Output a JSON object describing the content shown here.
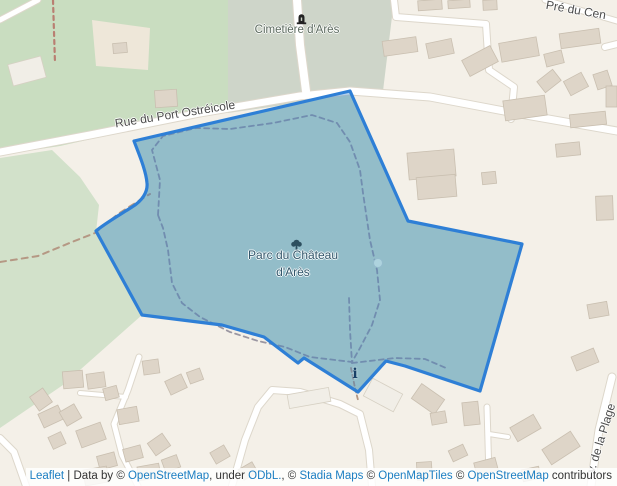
{
  "window": {
    "width": 617,
    "height": 486,
    "app": "Leaflet map"
  },
  "colors": {
    "background": "#f4f0e8",
    "wood_north": "#c9ddc0",
    "wood_west": "#d2e1ca",
    "cemetery": "#ced5c9",
    "clearing": "#eee7d9",
    "park_base": "#cfe0ca",
    "road_fill": "#ffffff",
    "road_casing": "#ddd7cb",
    "building": "#ded5c8",
    "building_stroke": "#c9bfb0",
    "building_light": "#f1eee7",
    "building_light_stroke": "#d6d0c3",
    "overlay_fill": "rgba(34,124,201,0.35)",
    "overlay_stroke": "#2e7fd6",
    "path_gray": "#9b97a2",
    "path_brown": "#b59884",
    "fence_brown": "#b97f72",
    "pond_fill": "#aed3de",
    "pond_stroke": "#95bccd",
    "label_park": "#33576b",
    "label_cemetery": "#5c6b5f",
    "label_road": "#4c4c4c",
    "link_blue": "#1b7ec2",
    "attribution_text": "#333333",
    "grave_icon": "#222222",
    "tree_icon": "#2d4f5f",
    "info_icon": "#173f66"
  },
  "labels": {
    "cemetery": "Cimetière d'Arès",
    "park_line1": "Parc du Château",
    "park_line2": "d'Arès",
    "road_main": "Rue du Port Ostréicole",
    "road_top_right": "Pré du Cen",
    "road_right": "v. de la Plage",
    "info_marker": "i"
  },
  "attribution": {
    "segments": [
      {
        "text": "Leaflet",
        "link": true
      },
      {
        "text": " | Data by © ",
        "link": false
      },
      {
        "text": "OpenStreetMap",
        "link": true
      },
      {
        "text": ", under ",
        "link": false
      },
      {
        "text": "ODbL.",
        "link": true
      },
      {
        "text": ", © ",
        "link": false
      },
      {
        "text": "Stadia Maps",
        "link": true
      },
      {
        "text": " © ",
        "link": false
      },
      {
        "text": "OpenMapTiles",
        "link": true
      },
      {
        "text": " © ",
        "link": false
      },
      {
        "text": "OpenStreetMap",
        "link": true
      },
      {
        "text": " contributors",
        "link": false
      }
    ]
  },
  "map": {
    "regions": [
      {
        "name": "wood-north",
        "fill": "#c9ddc0",
        "pts": [
          [
            0,
            0
          ],
          [
            228,
            0
          ],
          [
            228,
            112
          ],
          [
            150,
            126
          ],
          [
            60,
            146
          ],
          [
            0,
            155
          ]
        ]
      },
      {
        "name": "wood-west",
        "fill": "#d2e1ca",
        "pts": [
          [
            0,
            158
          ],
          [
            52,
            150
          ],
          [
            80,
            177
          ],
          [
            99,
            205
          ],
          [
            96,
            232
          ],
          [
            142,
            315
          ],
          [
            63,
            385
          ],
          [
            0,
            428
          ]
        ]
      },
      {
        "name": "cemetery-grounds",
        "fill": "#ced5c9",
        "pts": [
          [
            228,
            0
          ],
          [
            394,
            0
          ],
          [
            383,
            91
          ],
          [
            228,
            113
          ]
        ]
      },
      {
        "name": "clearing",
        "fill": "#eee7d9",
        "pts": [
          [
            92,
            20
          ],
          [
            150,
            28
          ],
          [
            148,
            70
          ],
          [
            96,
            66
          ]
        ]
      }
    ],
    "park": {
      "path": "M350,91 L408,221 L522,244 L480,391 L405,366 L386,361 L358,392 L304,358 L298,363 L264,337 L222,325 L142,315 L96,231 C104,224 118,216 132,207 C142,201 148,192 147,183 C146,170 138,152 134,141 Z"
    },
    "roads": [
      {
        "w": 7,
        "pts": [
          [
            0,
            152
          ],
          [
            90,
            135
          ],
          [
            200,
            113
          ],
          [
            300,
            96
          ],
          [
            350,
            91
          ],
          [
            430,
            97
          ],
          [
            520,
            114
          ],
          [
            617,
            131
          ]
        ]
      },
      {
        "w": 8,
        "pts": [
          [
            297,
            0
          ],
          [
            300,
            45
          ],
          [
            306,
            91
          ]
        ]
      },
      {
        "w": 6,
        "pts": [
          [
            394,
            0
          ],
          [
            396,
            17
          ],
          [
            486,
            24
          ],
          [
            489,
            70
          ],
          [
            514,
            87
          ],
          [
            511,
            119
          ]
        ]
      },
      {
        "w": 6,
        "pts": [
          [
            605,
            47
          ],
          [
            617,
            44
          ]
        ]
      },
      {
        "w": 5,
        "pts": [
          [
            545,
            0
          ],
          [
            617,
            21
          ]
        ]
      },
      {
        "w": 6,
        "pts": [
          [
            0,
            438
          ],
          [
            14,
            452
          ],
          [
            26,
            486
          ]
        ]
      },
      {
        "w": 5,
        "pts": [
          [
            139,
            357
          ],
          [
            128,
            390
          ],
          [
            114,
            424
          ],
          [
            122,
            455
          ],
          [
            138,
            486
          ]
        ]
      },
      {
        "w": 4,
        "pts": [
          [
            80,
            393
          ],
          [
            126,
            397
          ]
        ]
      },
      {
        "w": 6,
        "pts": [
          [
            232,
            486
          ],
          [
            245,
            440
          ],
          [
            258,
            407
          ],
          [
            272,
            390
          ],
          [
            300,
            392
          ],
          [
            340,
            404
          ],
          [
            360,
            414
          ],
          [
            369,
            450
          ],
          [
            372,
            486
          ]
        ]
      },
      {
        "w": 5,
        "pts": [
          [
            487,
            407
          ],
          [
            489,
            477
          ]
        ]
      },
      {
        "w": 4,
        "pts": [
          [
            489,
            434
          ],
          [
            508,
            437
          ]
        ]
      },
      {
        "w": 7,
        "pts": [
          [
            612,
            377
          ],
          [
            599,
            430
          ],
          [
            591,
            486
          ]
        ]
      },
      {
        "w": 5,
        "pts": [
          [
            0,
            20
          ],
          [
            38,
            0
          ]
        ]
      }
    ],
    "paths": [
      {
        "color": "#b59884",
        "w": 2,
        "dash": "6,5",
        "pts": [
          [
            0,
            262
          ],
          [
            38,
            256
          ],
          [
            72,
            242
          ],
          [
            95,
            233
          ],
          [
            118,
            214
          ],
          [
            140,
            200
          ],
          [
            150,
            194
          ]
        ]
      },
      {
        "color": "#b97f72",
        "w": 2.2,
        "dash": "4,4",
        "pts": [
          [
            53,
            0
          ],
          [
            54,
            32
          ],
          [
            55,
            63
          ]
        ]
      },
      {
        "color": "#b59884",
        "w": 1.8,
        "dash": "4,3",
        "pts": [
          [
            351,
            368
          ],
          [
            355,
            388
          ],
          [
            358,
            400
          ]
        ]
      },
      {
        "color": "#9b97a2",
        "w": 1.8,
        "dash": "5,4",
        "pts": [
          [
            158,
            215
          ],
          [
            160,
            180
          ],
          [
            152,
            150
          ],
          [
            163,
            136
          ],
          [
            196,
            128
          ],
          [
            230,
            129
          ],
          [
            273,
            123
          ],
          [
            312,
            115
          ],
          [
            337,
            123
          ],
          [
            350,
            142
          ],
          [
            360,
            170
          ],
          [
            363,
            193
          ],
          [
            370,
            240
          ],
          [
            377,
            270
          ],
          [
            380,
            300
          ],
          [
            372,
            325
          ],
          [
            360,
            348
          ],
          [
            352,
            362
          ],
          [
            310,
            357
          ],
          [
            285,
            347
          ],
          [
            258,
            341
          ],
          [
            230,
            332
          ],
          [
            200,
            317
          ],
          [
            182,
            303
          ],
          [
            172,
            283
          ],
          [
            168,
            250
          ],
          [
            163,
            228
          ],
          [
            158,
            215
          ]
        ]
      },
      {
        "color": "#9b97a2",
        "w": 1.8,
        "dash": "5,4",
        "pts": [
          [
            349,
            298
          ],
          [
            350,
            330
          ],
          [
            352,
            363
          ]
        ]
      },
      {
        "color": "#9b97a2",
        "w": 1.8,
        "dash": "5,4",
        "pts": [
          [
            352,
            363
          ],
          [
            395,
            358
          ],
          [
            425,
            359
          ],
          [
            446,
            368
          ]
        ]
      }
    ],
    "buildings": [
      [
        10,
        60,
        34,
        22,
        -15,
        "light"
      ],
      [
        113,
        43,
        14,
        10,
        -5
      ],
      [
        155,
        90,
        22,
        17,
        -4
      ],
      [
        383,
        39,
        34,
        15,
        -8
      ],
      [
        427,
        41,
        26,
        15,
        -12
      ],
      [
        464,
        52,
        32,
        18,
        -28
      ],
      [
        500,
        40,
        38,
        19,
        -10
      ],
      [
        545,
        52,
        18,
        13,
        -14
      ],
      [
        560,
        31,
        40,
        15,
        -8
      ],
      [
        539,
        74,
        20,
        14,
        -38
      ],
      [
        566,
        76,
        20,
        16,
        -28
      ],
      [
        595,
        72,
        15,
        16,
        -18
      ],
      [
        418,
        0,
        24,
        10,
        -4
      ],
      [
        448,
        0,
        22,
        8,
        -4
      ],
      [
        483,
        0,
        14,
        10,
        -3
      ],
      [
        504,
        98,
        42,
        20,
        -8
      ],
      [
        606,
        86,
        11,
        21,
        0
      ],
      [
        570,
        113,
        36,
        13,
        -6
      ],
      [
        556,
        143,
        24,
        13,
        -6
      ],
      [
        596,
        196,
        17,
        24,
        -2
      ],
      [
        482,
        172,
        14,
        12,
        -6
      ],
      [
        408,
        151,
        47,
        27,
        -5
      ],
      [
        417,
        176,
        39,
        22,
        -5
      ],
      [
        588,
        303,
        20,
        14,
        -10
      ],
      [
        573,
        352,
        24,
        15,
        -22
      ],
      [
        63,
        371,
        20,
        17,
        -5
      ],
      [
        87,
        373,
        18,
        15,
        -8
      ],
      [
        33,
        391,
        16,
        17,
        -35
      ],
      [
        40,
        409,
        22,
        15,
        -25
      ],
      [
        62,
        407,
        17,
        16,
        -30
      ],
      [
        78,
        426,
        26,
        18,
        -20
      ],
      [
        50,
        434,
        14,
        13,
        -25
      ],
      [
        104,
        387,
        14,
        12,
        -15
      ],
      [
        118,
        408,
        20,
        15,
        -10
      ],
      [
        98,
        454,
        18,
        14,
        -15
      ],
      [
        84,
        468,
        24,
        16,
        -10
      ],
      [
        124,
        447,
        18,
        13,
        -15
      ],
      [
        150,
        437,
        18,
        15,
        -35
      ],
      [
        138,
        465,
        22,
        14,
        -10
      ],
      [
        163,
        457,
        16,
        13,
        -20
      ],
      [
        143,
        360,
        16,
        14,
        -8
      ],
      [
        167,
        377,
        18,
        15,
        -25
      ],
      [
        188,
        370,
        14,
        12,
        -20
      ],
      [
        212,
        448,
        16,
        13,
        -30
      ],
      [
        240,
        465,
        16,
        12,
        -30
      ],
      [
        288,
        391,
        42,
        14,
        -10,
        "light"
      ],
      [
        366,
        385,
        34,
        20,
        28,
        "light"
      ],
      [
        414,
        390,
        28,
        18,
        35
      ],
      [
        463,
        402,
        16,
        23,
        -6
      ],
      [
        431,
        412,
        15,
        12,
        -10
      ],
      [
        512,
        420,
        27,
        16,
        -30
      ],
      [
        544,
        439,
        34,
        18,
        -33
      ],
      [
        450,
        447,
        16,
        12,
        -25
      ],
      [
        475,
        460,
        22,
        13,
        -15
      ],
      [
        522,
        468,
        18,
        12,
        -12
      ],
      [
        417,
        462,
        15,
        18,
        -4
      ]
    ],
    "pond": {
      "cx": 378,
      "cy": 263,
      "r": 4.5
    }
  }
}
